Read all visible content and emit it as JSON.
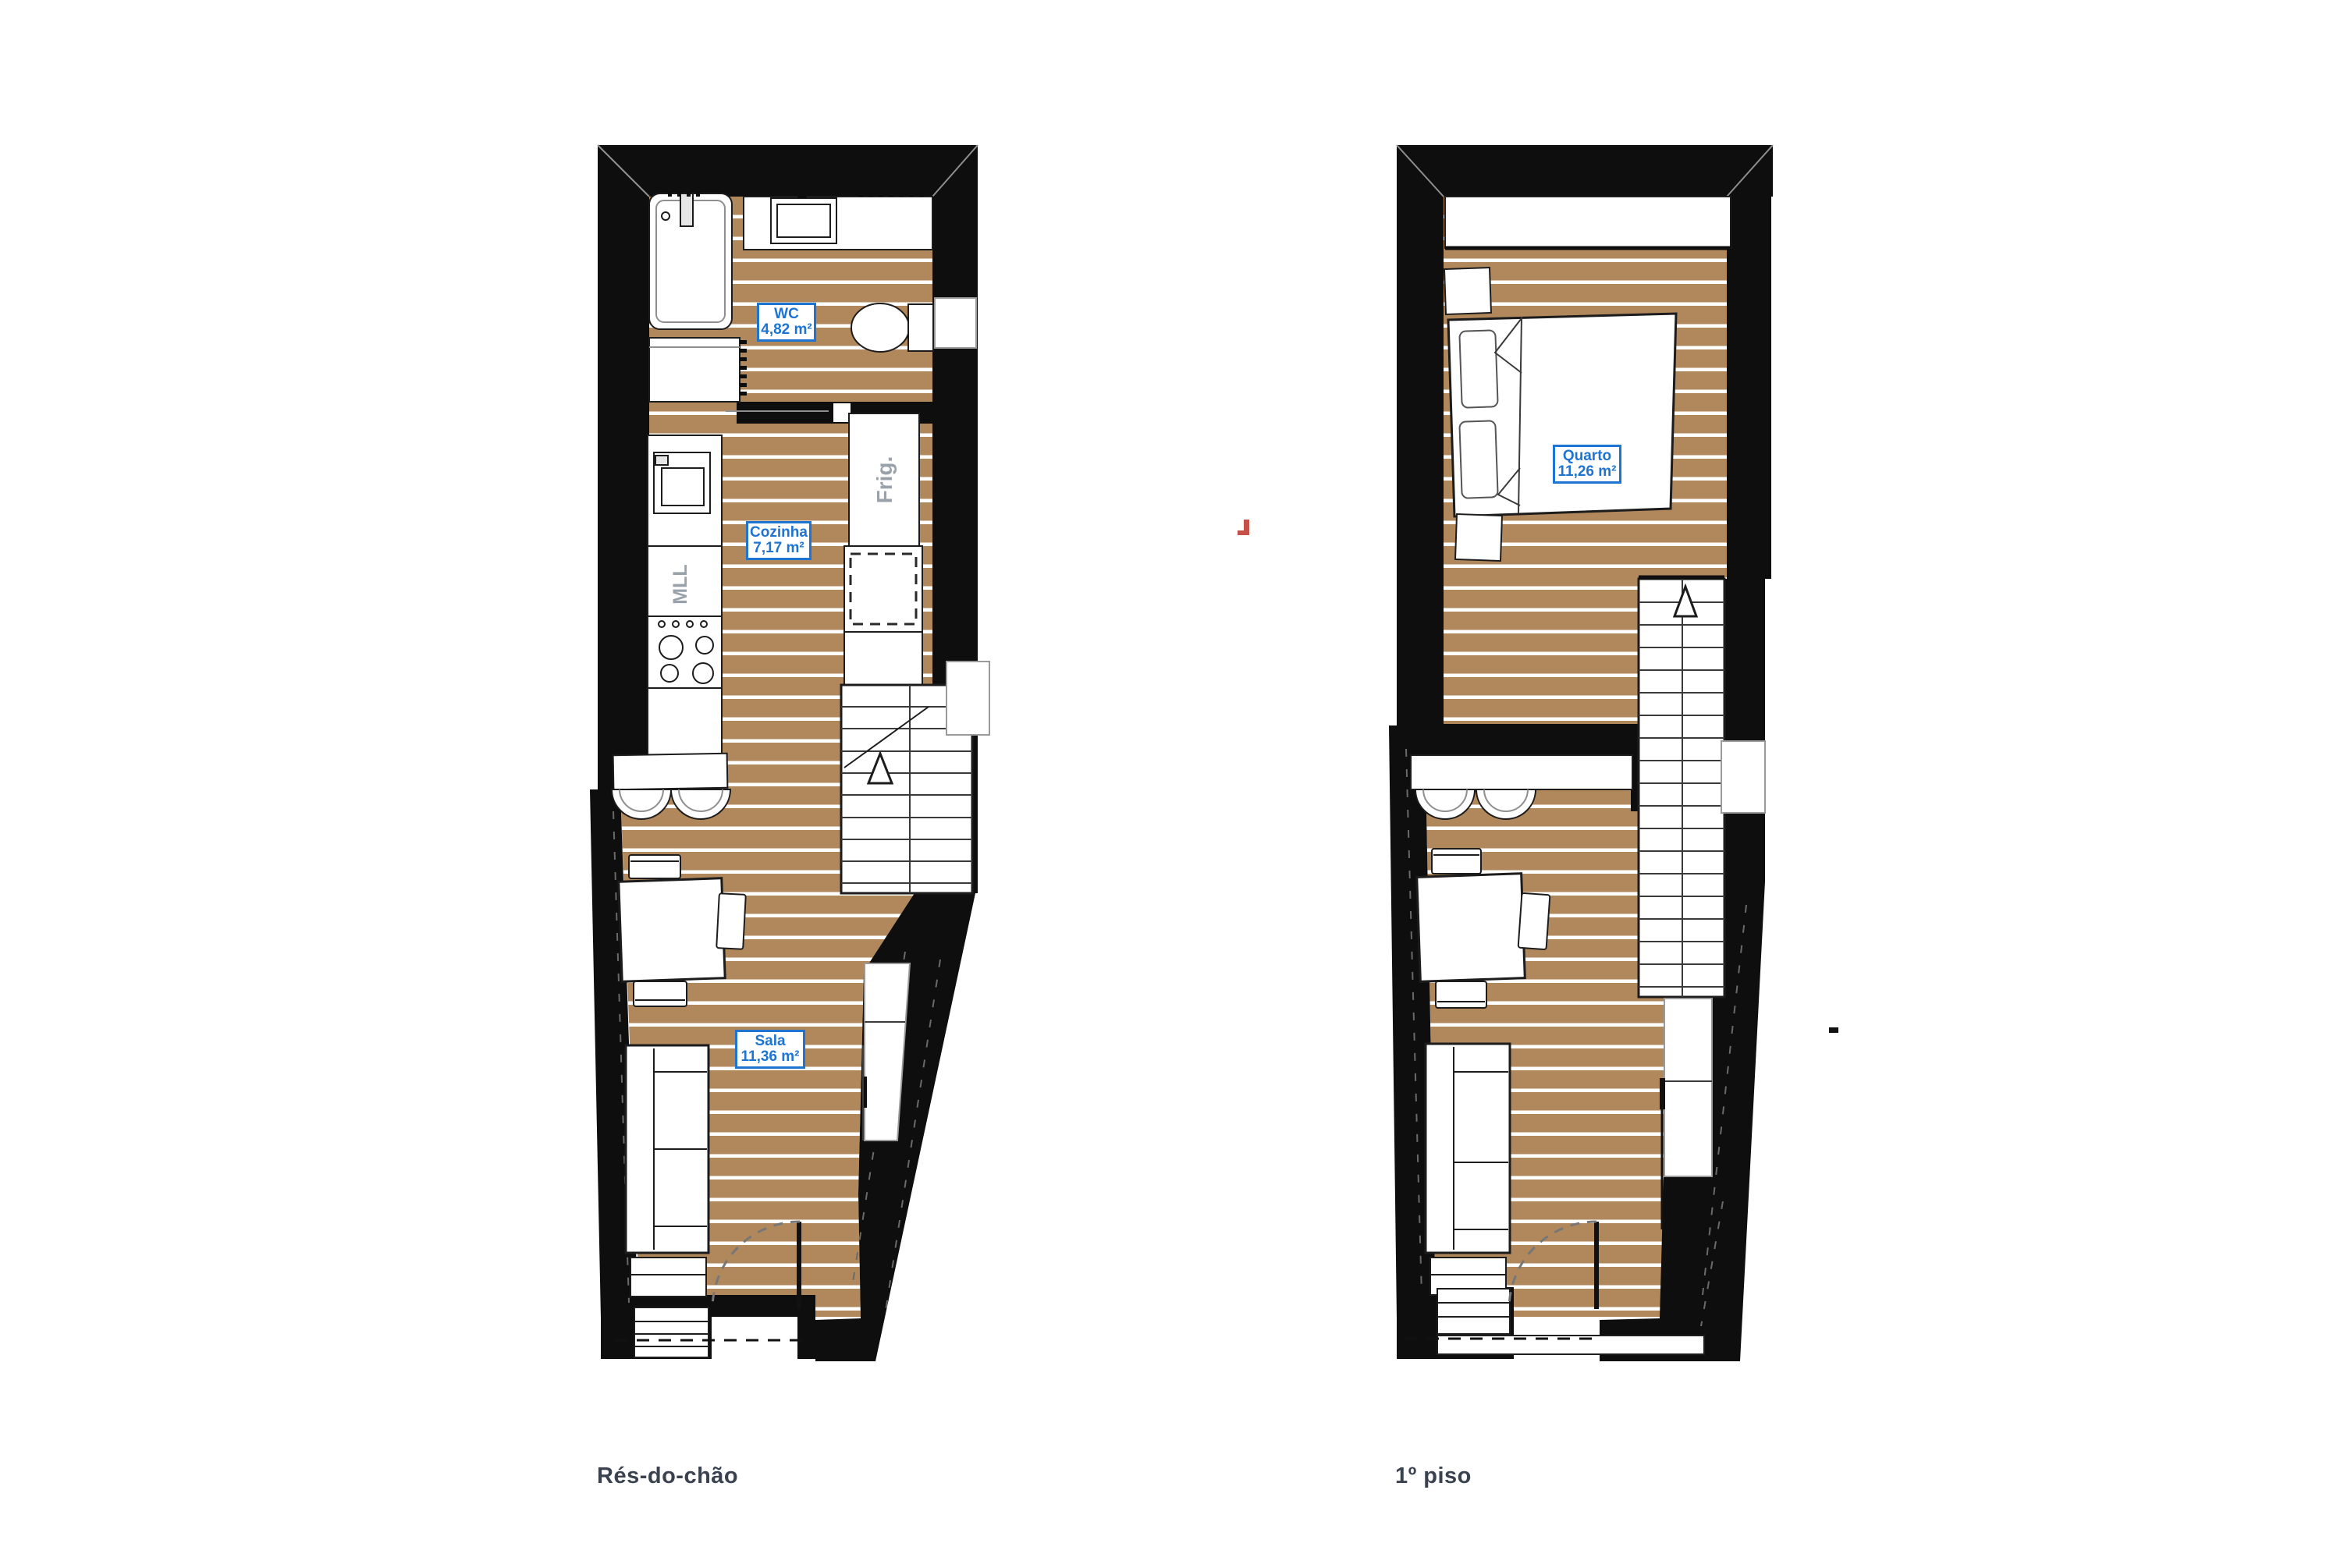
{
  "document": {
    "type": "architectural floor plan drawing",
    "background": "#ffffff"
  },
  "colors": {
    "wall": "#0e0e0e",
    "floor_wood": "#b1875c",
    "floor_stripe": "#ffffff",
    "fixture_outline": "#1c1c1c",
    "room_label_text": "#1e74d2",
    "room_label_border": "#1e74d2",
    "room_label_background": "#ffffff",
    "caption_text": "#3a4250",
    "appliance_text": "#99a1aa",
    "red_mark": "#c65149"
  },
  "plans": [
    {
      "id": "ground-floor",
      "caption": "Rés-do-chão",
      "rooms": [
        {
          "name": "WC",
          "area": "4,82 m²"
        },
        {
          "name": "Cozinha",
          "area": "7,17 m²"
        },
        {
          "name": "Sala",
          "area": "11,36 m²"
        }
      ],
      "appliance_labels": {
        "fridge": "Frig.",
        "dishwasher": "MLL"
      }
    },
    {
      "id": "first-floor",
      "caption": "1º piso",
      "rooms": [
        {
          "name": "Quarto",
          "area": "11,26 m²"
        }
      ]
    }
  ]
}
